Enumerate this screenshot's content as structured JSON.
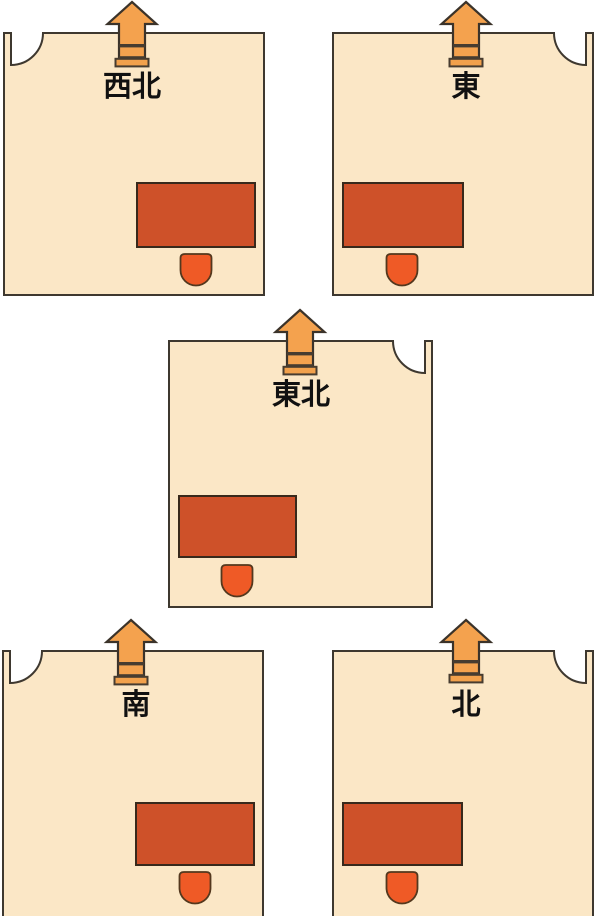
{
  "diagram": {
    "background": "#ffffff",
    "colors": {
      "room_fill": "#FBE7C6",
      "room_outline": "#3E382F",
      "arrow_fill": "#F4A24E",
      "arrow_outline": "#3B332A",
      "threshold_line": "#473C30",
      "sill_fill": "#F2A14C",
      "desk_fill": "#CE5129",
      "desk_outline": "#38291B",
      "chair_fill": "#EF5A26",
      "chair_outline": "#53381E",
      "label_color": "#111111",
      "door_swing_fill": "#FFFFFF"
    },
    "rooms": [
      {
        "label": "西北",
        "door_corner": "top-left",
        "desk_side": "right"
      },
      {
        "label": "東",
        "door_corner": "top-right",
        "desk_side": "left"
      },
      {
        "label": "東北",
        "door_corner": "top-right",
        "desk_side": "left"
      },
      {
        "label": "南",
        "door_corner": "top-left",
        "desk_side": "right"
      },
      {
        "label": "北",
        "door_corner": "top-right",
        "desk_side": "left"
      }
    ]
  }
}
